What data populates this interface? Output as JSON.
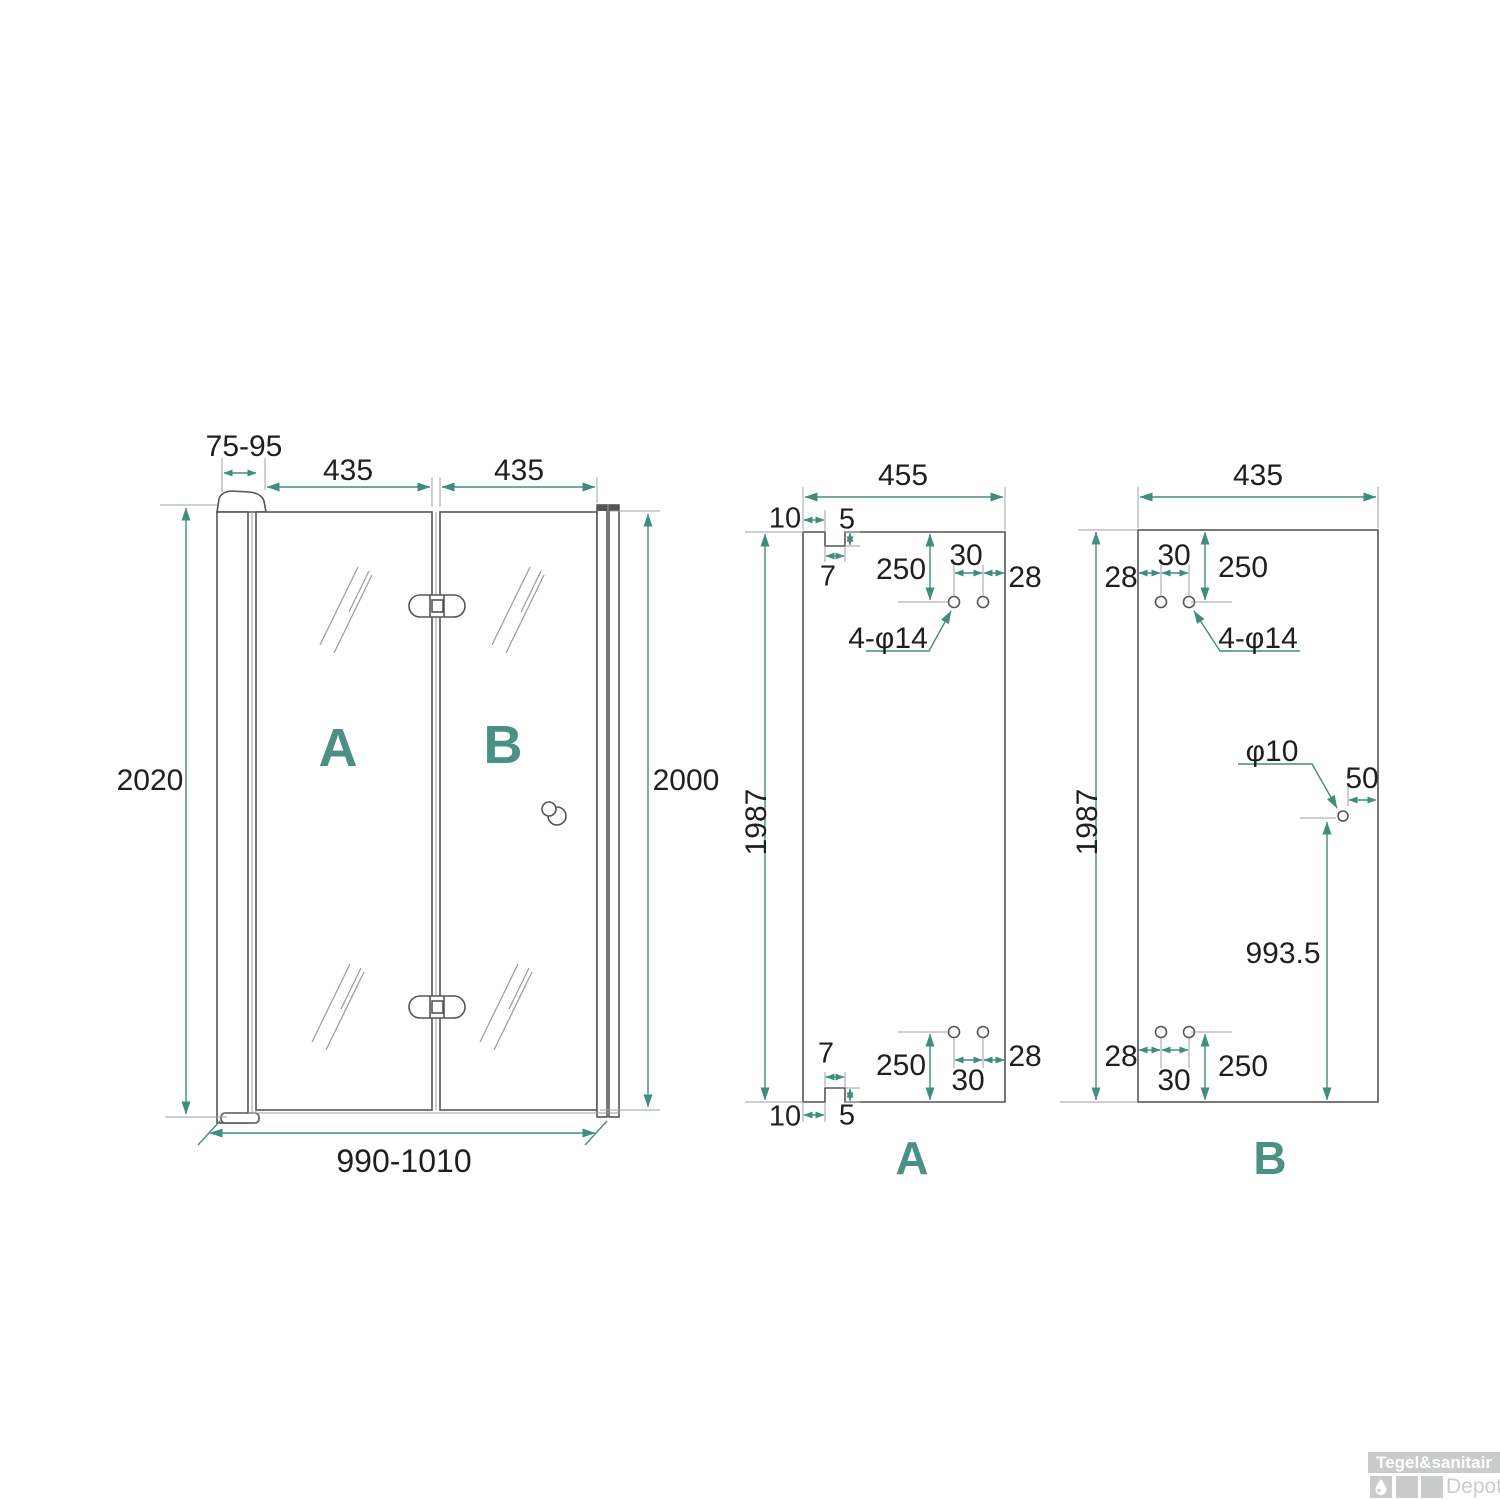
{
  "colors": {
    "accent_teal": "#3F8E7D",
    "letter_teal": "#4a9184",
    "drawing_line": "#555555",
    "extension_line": "#9aa0a0",
    "dimension_text": "#1f1f1f",
    "watermark_gray": "#c9cccb"
  },
  "assembly_view": {
    "wall_profile_adjust_range": "75-95",
    "door_a_width": "435",
    "door_b_width": "435",
    "total_height_left": "2020",
    "total_height_right": "2000",
    "total_width_range": "990-1010",
    "label_a": "A",
    "label_b": "B"
  },
  "panel_a_view": {
    "width": "455",
    "glass_height": "1987",
    "label": "A",
    "top": {
      "notch_offset": "10",
      "notch_depth": "5",
      "notch_width": "7",
      "holes_distance_from_top": "250",
      "holes_spacing": "30",
      "holes_edge_distance": "28",
      "holes_spec": "4-φ14"
    },
    "bottom": {
      "notch_width": "7",
      "holes_distance_from_bottom": "250",
      "holes_spacing": "30",
      "holes_edge_distance": "28",
      "notch_offset": "10",
      "notch_depth": "5"
    }
  },
  "panel_b_view": {
    "width": "435",
    "glass_height": "1987",
    "label": "B",
    "top": {
      "holes_edge_distance": "28",
      "holes_spacing": "30",
      "holes_distance_from_top": "250",
      "holes_spec": "4-φ14"
    },
    "handle_hole": {
      "diameter": "φ10",
      "edge_distance": "50",
      "distance_from_bottom": "993.5"
    },
    "bottom": {
      "holes_edge_distance": "28",
      "holes_spacing": "30",
      "holes_distance_from_bottom": "250"
    }
  },
  "watermark": {
    "brand": "Tegel&sanitair",
    "suffix": "Depot"
  }
}
